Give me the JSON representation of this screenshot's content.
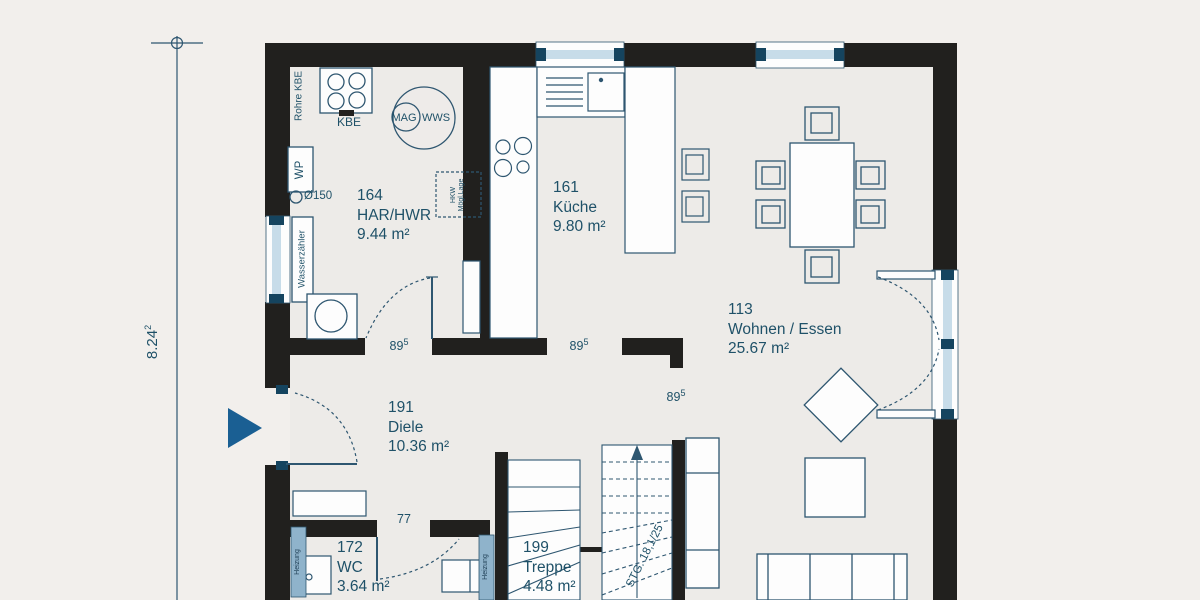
{
  "rooms": [
    {
      "number": "164",
      "name": "HAR/HWR",
      "area": "9.44 m²"
    },
    {
      "number": "161",
      "name": "Küche",
      "area": "9.80 m²"
    },
    {
      "number": "113",
      "name": "Wohnen / Essen",
      "area": "25.67 m²"
    },
    {
      "number": "191",
      "name": "Diele",
      "area": "10.36 m²"
    },
    {
      "number": "172",
      "name": "WC",
      "area": "3.64 m²"
    },
    {
      "number": "199",
      "name": "Treppe",
      "area": "4.48 m²"
    }
  ],
  "equipment": {
    "rohre_kbe": "Rohre KBE",
    "kbe": "KBE",
    "mag": "MAG",
    "wws": "WWS",
    "wp": "WP",
    "diameter": "Ø150",
    "wasserzaehler": "Wasserzähler",
    "hkw_line1": "HKW",
    "hkw_line2": "Mögl.Lage",
    "heizung": "Heizung"
  },
  "dimensions": {
    "overall": {
      "value": "8.24",
      "sup": "2"
    },
    "door_width": "77",
    "stairs_label": "STG. 18,1/25",
    "openings": [
      {
        "value": "89",
        "sup": "5"
      },
      {
        "value": "89",
        "sup": "5"
      },
      {
        "value": "89",
        "sup": "5"
      }
    ]
  },
  "colors": {
    "wall": "#21201e",
    "line": "#2e5670",
    "text": "#1f5168",
    "glazing": "#c7dce9",
    "glazing_dark": "#15445f",
    "radiator": "#8fb3cb",
    "entrance_arrow": "#1a5f93",
    "floor": "#edebe8",
    "background": "#f2efec"
  }
}
